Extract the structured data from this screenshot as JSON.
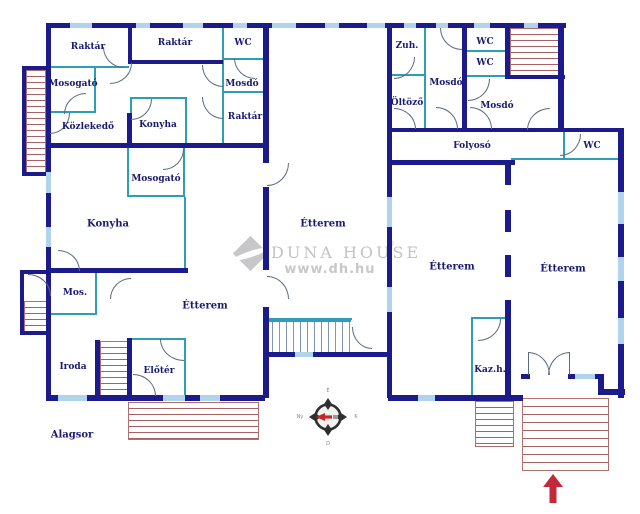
{
  "plan": {
    "floor_name": "Alagsor",
    "language": "Hungarian"
  },
  "rooms": [
    {
      "name": "raktar-1",
      "label": "Raktár"
    },
    {
      "name": "raktar-2",
      "label": "Raktár"
    },
    {
      "name": "wc-1",
      "label": "WC"
    },
    {
      "name": "mosdo-1",
      "label": "Mosdó"
    },
    {
      "name": "raktar-3",
      "label": "Raktár"
    },
    {
      "name": "mosogato-1",
      "label": "Mosogató"
    },
    {
      "name": "kozlekedo",
      "label": "Közlekedő"
    },
    {
      "name": "konyha-1",
      "label": "Konyha"
    },
    {
      "name": "mosogato-2",
      "label": "Mosogató"
    },
    {
      "name": "konyha-2",
      "label": "Konyha"
    },
    {
      "name": "mos",
      "label": "Mos."
    },
    {
      "name": "iroda",
      "label": "Iroda"
    },
    {
      "name": "eloter",
      "label": "Előtér"
    },
    {
      "name": "etterem-left",
      "label": "Étterem"
    },
    {
      "name": "etterem-middle",
      "label": "Étterem"
    },
    {
      "name": "zuh",
      "label": "Zuh."
    },
    {
      "name": "mosdo-2",
      "label": "Mosdó"
    },
    {
      "name": "wc-2",
      "label": "WC"
    },
    {
      "name": "wc-3",
      "label": "WC"
    },
    {
      "name": "oltozo",
      "label": "Öltöző"
    },
    {
      "name": "mosdo-3",
      "label": "Mosdó"
    },
    {
      "name": "folyoso",
      "label": "Folyosó"
    },
    {
      "name": "wc-4",
      "label": "WC"
    },
    {
      "name": "etterem-right-1",
      "label": "Étterem"
    },
    {
      "name": "etterem-right-2",
      "label": "Étterem"
    },
    {
      "name": "kaz-h",
      "label": "Kaz.h."
    },
    {
      "name": "alagsor",
      "label": "Alagsor"
    }
  ],
  "watermark": {
    "brand_text": "DUNA HOUSE",
    "registered": "®",
    "url": "www.dh.hu"
  },
  "compass": {
    "top": "É",
    "right": "K",
    "bottom": "D",
    "left": "Ny"
  },
  "colors": {
    "wall": "#1b1b8c",
    "partition": "#2d9db8",
    "window": "#b0d4ec",
    "stairs": "#a86060",
    "entrance_arrow": "#c22a3a",
    "label": "#1a1a70",
    "watermark": "#c3c3c5"
  }
}
